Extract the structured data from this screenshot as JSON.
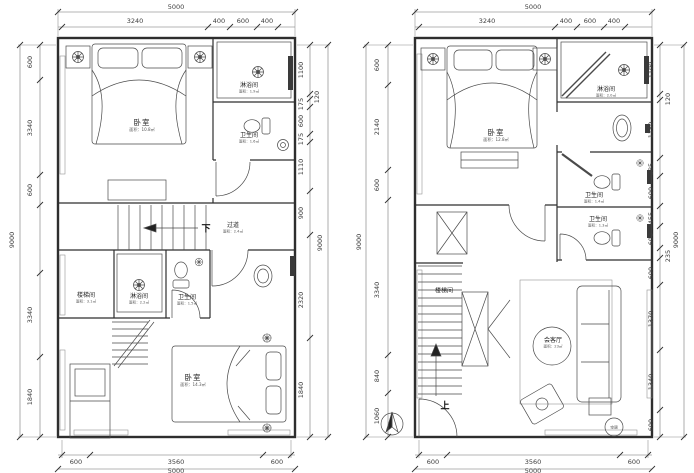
{
  "page": {
    "title": "户型平面图"
  },
  "plans": {
    "left": {
      "flow_down": "下",
      "dims": {
        "top_overall": "5000",
        "top_segments": [
          "3240",
          "400",
          "600",
          "400"
        ],
        "left_overall": "9000",
        "left_segments": [
          "600",
          "3340",
          "600",
          "3340",
          "1840"
        ],
        "right_overall": "9000",
        "right_segments": [
          "1100",
          "120",
          "175",
          "600",
          "175",
          "1110",
          "900",
          "2320",
          "1840"
        ],
        "bottom_overall": "5000",
        "bottom_segments": [
          "600",
          "3560",
          "600"
        ]
      },
      "rooms": {
        "bedroom_top": {
          "label": "卧室",
          "area": "面积：10.8㎡"
        },
        "shower_top": {
          "label": "淋浴间",
          "area": "面积：1.9㎡"
        },
        "bath_top": {
          "label": "卫生间",
          "area": "面积：1.6㎡"
        },
        "corridor": {
          "label": "过道",
          "area": "面积：2.4㎡"
        },
        "stairwell": {
          "label": "楼梯间",
          "area": "面积：3.1㎡"
        },
        "shower_mid": {
          "label": "淋浴间",
          "area": "面积：2.2㎡"
        },
        "bath_mid": {
          "label": "卫生间",
          "area": "面积：1.5㎡"
        },
        "bedroom_bottom": {
          "label": "卧室",
          "area": "面积：14.3㎡"
        }
      }
    },
    "right": {
      "flow_up": "上",
      "dims": {
        "top_overall": "5000",
        "top_segments": [
          "3240",
          "400",
          "600",
          "400"
        ],
        "left_overall": "9000",
        "left_segments": [
          "600",
          "2140",
          "600",
          "3340",
          "840",
          "1060"
        ],
        "right_overall": "9000",
        "right_segments": [
          "1100",
          "120",
          "1150",
          "385",
          "600",
          "455",
          "600",
          "235",
          "600",
          "1370",
          "1340",
          "600"
        ],
        "bottom_overall": "5000",
        "bottom_segments": [
          "600",
          "3560",
          "600"
        ]
      },
      "rooms": {
        "bedroom_top": {
          "label": "卧室",
          "area": "面积：12.8㎡"
        },
        "shower_top": {
          "label": "淋浴间",
          "area": "面积：2.0㎡"
        },
        "bath_1": {
          "label": "卫生间",
          "area": "面积：1.4㎡"
        },
        "bath_2": {
          "label": "卫生间",
          "area": "面积：1.3㎡"
        },
        "stairwell": {
          "label": "楼梯间"
        },
        "living": {
          "label": "会客厅",
          "area": "面积：23㎡"
        },
        "ac": {
          "label": "空调"
        }
      }
    }
  }
}
